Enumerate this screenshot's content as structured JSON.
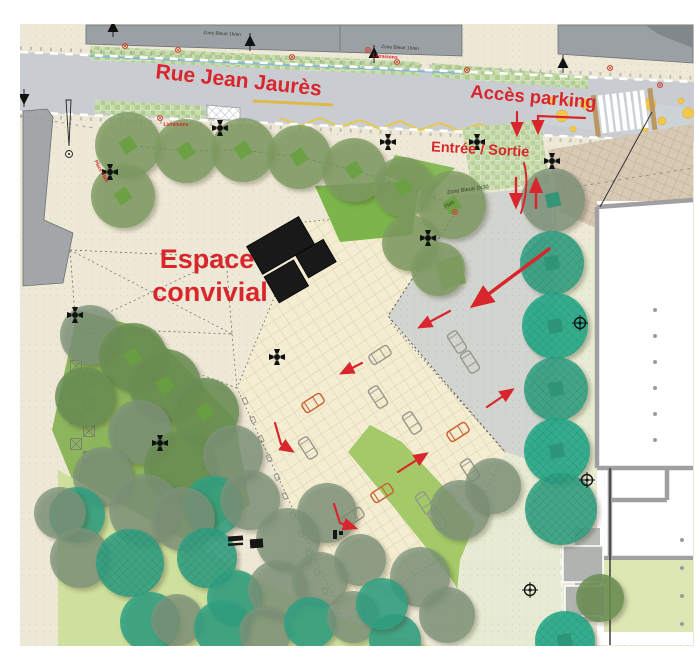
{
  "map_labels": {
    "street_name": "Rue Jean Jaurès",
    "parking_access": "Accès parking",
    "entrance_exit": "Entrée / Sortie",
    "convivial_line1": "Espace",
    "convivial_line2": "convivial",
    "deliveries_north": "Livraisons",
    "deliveries_south": "Livraisons",
    "blue_zone_west": "Zone Bleue 1h/en",
    "blue_zone_east": "Zone Bleue 1h/en",
    "blue_zone_tree": "Zone Bleue 1h30",
    "pmr_spot": "PMR",
    "pmr_place": "Place PMR"
  },
  "colors": {
    "annotation_red": "#d8262c",
    "road_gray": "#c9cdd2",
    "sidewalk_beige": "#eee9d6",
    "plaza_beige": "#f4edd2",
    "driveway_gray": "#d2d4cf",
    "planting_strip_green": "#bcd49e",
    "lawn_bright_green": "#7cb54a",
    "lawn_pale_green": "#cfdf9d",
    "tree_olive": "#7f9c63",
    "tree_teal": "#2fa183",
    "building_gray": "#9aa0a3",
    "cobble_tan": "#d8c9b5",
    "structure_black": "#161616",
    "marking_yellow": "#e9c94e"
  }
}
